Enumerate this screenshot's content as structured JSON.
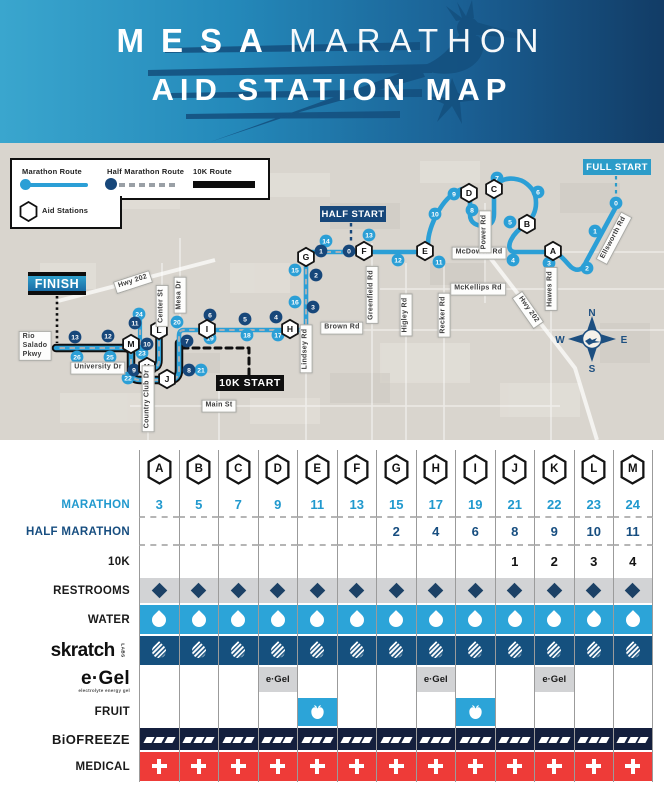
{
  "header": {
    "title_word1": "MESA",
    "title_word2": "MARATHON",
    "subtitle": "AID STATION MAP"
  },
  "legend": {
    "marathon_route": "Marathon Route",
    "half_route": "Half Marathon Route",
    "tenk_route": "10K Route",
    "aid_stations": "Aid Stations"
  },
  "colors": {
    "marathon_blue": "#2b9fd6",
    "half_navy": "#17477a",
    "tenk_black": "#0f0f0f",
    "water_blue": "#2ca4d8",
    "skratch_blue": "#15507e",
    "restroom_gray": "#d2d3d5",
    "biofreeze_navy": "#141f3d",
    "medical_red": "#ee3b38",
    "route_dash_gray": "#aab0b5"
  },
  "map": {
    "start_labels": {
      "full_start": "FULL START",
      "half_start": "HALF START",
      "finish": "FINISH",
      "tenk_start": "10K START"
    },
    "compass": {
      "n": "N",
      "e": "E",
      "s": "S",
      "w": "W"
    },
    "roads": [
      {
        "text": "Hwy 202",
        "x": 133,
        "y": 139,
        "rot": -18
      },
      {
        "text": "Rio\nSalado\nPkwy",
        "x": 35,
        "y": 203,
        "rot": 0,
        "align": "left"
      },
      {
        "text": "Center St",
        "x": 162,
        "y": 163,
        "rot": -90
      },
      {
        "text": "Mesa Dr",
        "x": 180,
        "y": 152,
        "rot": -90
      },
      {
        "text": "University Dr",
        "x": 98,
        "y": 225,
        "rot": 0
      },
      {
        "text": "Country Club Dr",
        "x": 148,
        "y": 256,
        "rot": -90
      },
      {
        "text": "Main St",
        "x": 219,
        "y": 263,
        "rot": 0
      },
      {
        "text": "Lindsey Rd",
        "x": 306,
        "y": 206,
        "rot": -90
      },
      {
        "text": "Brown Rd",
        "x": 342,
        "y": 185,
        "rot": 0
      },
      {
        "text": "Greenfield Rd",
        "x": 372,
        "y": 152,
        "rot": -90
      },
      {
        "text": "Higley Rd",
        "x": 406,
        "y": 172,
        "rot": -90
      },
      {
        "text": "Recker Rd",
        "x": 444,
        "y": 172,
        "rot": -90
      },
      {
        "text": "McKellips Rd",
        "x": 478,
        "y": 146,
        "rot": 0
      },
      {
        "text": "McDowell Rd",
        "x": 479,
        "y": 110,
        "rot": 0
      },
      {
        "text": "Power Rd",
        "x": 485,
        "y": 89,
        "rot": -90
      },
      {
        "text": "Hwy 202",
        "x": 528,
        "y": 167,
        "rot": 55
      },
      {
        "text": "Hawes Rd",
        "x": 551,
        "y": 146,
        "rot": -90
      },
      {
        "text": "Ellsworth Rd",
        "x": 614,
        "y": 95,
        "rot": -62
      }
    ],
    "stations": [
      {
        "letter": "A",
        "x": 553,
        "y": 108
      },
      {
        "letter": "B",
        "x": 527,
        "y": 81
      },
      {
        "letter": "C",
        "x": 494,
        "y": 46
      },
      {
        "letter": "D",
        "x": 469,
        "y": 50
      },
      {
        "letter": "E",
        "x": 425,
        "y": 108
      },
      {
        "letter": "F",
        "x": 364,
        "y": 108
      },
      {
        "letter": "G",
        "x": 306,
        "y": 114
      },
      {
        "letter": "H",
        "x": 290,
        "y": 186
      },
      {
        "letter": "I",
        "x": 207,
        "y": 186
      },
      {
        "letter": "J",
        "x": 167,
        "y": 236
      },
      {
        "letter": "K",
        "x": 147,
        "y": 224
      },
      {
        "letter": "L",
        "x": 159,
        "y": 187
      },
      {
        "letter": "M",
        "x": 131,
        "y": 201
      }
    ],
    "marathon_miles": [
      {
        "n": "0",
        "x": 616,
        "y": 60
      },
      {
        "n": "1",
        "x": 595,
        "y": 88
      },
      {
        "n": "2",
        "x": 587,
        "y": 125
      },
      {
        "n": "3",
        "x": 549,
        "y": 120
      },
      {
        "n": "4",
        "x": 513,
        "y": 117
      },
      {
        "n": "5",
        "x": 510,
        "y": 79
      },
      {
        "n": "6",
        "x": 538,
        "y": 49
      },
      {
        "n": "7",
        "x": 497,
        "y": 35
      },
      {
        "n": "8",
        "x": 472,
        "y": 67
      },
      {
        "n": "9",
        "x": 454,
        "y": 51
      },
      {
        "n": "10",
        "x": 435,
        "y": 71
      },
      {
        "n": "11",
        "x": 439,
        "y": 119
      },
      {
        "n": "12",
        "x": 398,
        "y": 117
      },
      {
        "n": "13",
        "x": 369,
        "y": 92
      },
      {
        "n": "14",
        "x": 326,
        "y": 98
      },
      {
        "n": "15",
        "x": 295,
        "y": 127
      },
      {
        "n": "16",
        "x": 295,
        "y": 159
      },
      {
        "n": "17",
        "x": 278,
        "y": 192
      },
      {
        "n": "18",
        "x": 247,
        "y": 192
      },
      {
        "n": "19",
        "x": 210,
        "y": 195
      },
      {
        "n": "20",
        "x": 177,
        "y": 179
      },
      {
        "n": "21",
        "x": 201,
        "y": 227
      },
      {
        "n": "22",
        "x": 128,
        "y": 235
      },
      {
        "n": "23",
        "x": 142,
        "y": 210
      },
      {
        "n": "24",
        "x": 139,
        "y": 171
      },
      {
        "n": "25",
        "x": 110,
        "y": 214
      },
      {
        "n": "26",
        "x": 77,
        "y": 214
      }
    ],
    "half_miles": [
      {
        "n": "0",
        "x": 349,
        "y": 108
      },
      {
        "n": "1",
        "x": 321,
        "y": 108
      },
      {
        "n": "2",
        "x": 316,
        "y": 132
      },
      {
        "n": "3",
        "x": 313,
        "y": 164
      },
      {
        "n": "4",
        "x": 276,
        "y": 174
      },
      {
        "n": "5",
        "x": 245,
        "y": 176
      },
      {
        "n": "6",
        "x": 210,
        "y": 172
      },
      {
        "n": "7",
        "x": 187,
        "y": 198
      },
      {
        "n": "8",
        "x": 189,
        "y": 227
      },
      {
        "n": "9",
        "x": 134,
        "y": 227
      },
      {
        "n": "10",
        "x": 147,
        "y": 201
      },
      {
        "n": "11",
        "x": 135,
        "y": 180
      },
      {
        "n": "12",
        "x": 108,
        "y": 193
      },
      {
        "n": "13",
        "x": 75,
        "y": 194
      }
    ]
  },
  "table": {
    "columns": [
      "A",
      "B",
      "C",
      "D",
      "E",
      "F",
      "G",
      "H",
      "I",
      "J",
      "K",
      "L",
      "M"
    ],
    "rows": [
      {
        "id": "marathon",
        "label": "MARATHON",
        "label_style": "blue",
        "type": "numbers",
        "num_style": "blue",
        "divider": true,
        "values": [
          "3",
          "5",
          "7",
          "9",
          "11",
          "13",
          "15",
          "17",
          "19",
          "21",
          "22",
          "23",
          "24"
        ]
      },
      {
        "id": "half-marathon",
        "label": "HALF MARATHON",
        "label_style": "navy",
        "type": "numbers",
        "num_style": "navy",
        "divider": true,
        "values": [
          "",
          "",
          "",
          "",
          "",
          "",
          "2",
          "4",
          "6",
          "8",
          "9",
          "10",
          "11"
        ]
      },
      {
        "id": "10k",
        "label": "10K",
        "label_style": "black",
        "type": "numbers",
        "num_style": "black",
        "divider": false,
        "values": [
          "",
          "",
          "",
          "",
          "",
          "",
          "",
          "",
          "",
          "1",
          "2",
          "3",
          "4"
        ]
      },
      {
        "id": "restrooms",
        "label": "RESTROOMS",
        "label_style": "black",
        "type": "icons",
        "icon": "diamond",
        "band": "#d2d3d5",
        "cells": [
          1,
          1,
          1,
          1,
          1,
          1,
          1,
          1,
          1,
          1,
          1,
          1,
          1
        ]
      },
      {
        "id": "water",
        "label": "WATER",
        "label_style": "black",
        "type": "icons",
        "icon": "drop",
        "band": "#2ca4d8",
        "cells": [
          1,
          1,
          1,
          1,
          1,
          1,
          1,
          1,
          1,
          1,
          1,
          1,
          1
        ]
      },
      {
        "id": "skratch",
        "label": "skratch",
        "label_sub": "LABS",
        "label_style": "skratch",
        "type": "icons",
        "icon": "drop-hatch",
        "band": "#15507e",
        "cells": [
          1,
          1,
          1,
          1,
          1,
          1,
          1,
          1,
          1,
          1,
          1,
          1,
          1
        ]
      },
      {
        "id": "egel",
        "label": "e·Gel",
        "label_sub": "electrolyte energy gel",
        "label_style": "egel",
        "type": "egel",
        "cell_text": "e·Gel",
        "band": "#d2d3d5",
        "cells": [
          0,
          0,
          0,
          1,
          0,
          0,
          0,
          1,
          0,
          0,
          1,
          0,
          0
        ]
      },
      {
        "id": "fruit",
        "label": "FRUIT",
        "label_style": "black",
        "type": "icons",
        "icon": "apple",
        "band": "#2ca4d8",
        "cells": [
          0,
          0,
          0,
          0,
          1,
          0,
          0,
          0,
          1,
          0,
          0,
          0,
          0
        ]
      },
      {
        "id": "biofreeze",
        "label": "BiOFREEZE",
        "label_style": "bio",
        "type": "icons",
        "icon": "dashes",
        "band": "#141f3d",
        "cells": [
          1,
          1,
          1,
          1,
          1,
          1,
          1,
          1,
          1,
          1,
          1,
          1,
          1
        ]
      },
      {
        "id": "medical",
        "label": "MEDICAL",
        "label_style": "black",
        "type": "icons",
        "icon": "plus",
        "band": "#ee3b38",
        "cells": [
          1,
          1,
          1,
          1,
          1,
          1,
          1,
          1,
          1,
          1,
          1,
          1,
          1
        ]
      }
    ]
  }
}
